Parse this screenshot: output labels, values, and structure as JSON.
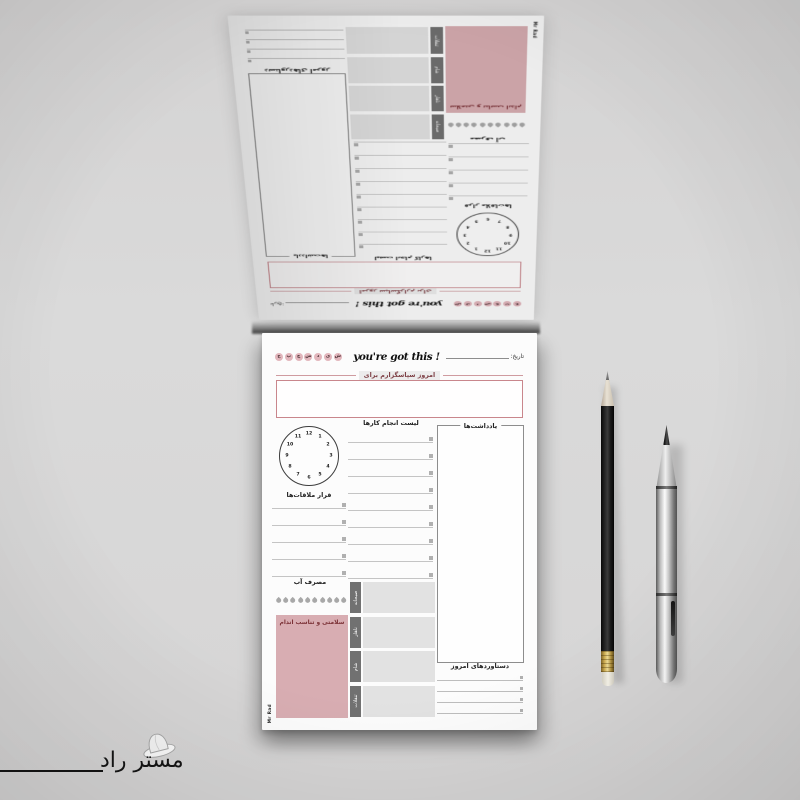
{
  "page": {
    "brand": "Mr Rad",
    "date_label": "تاریخ:",
    "motto": "you're got this !",
    "weekdays": [
      "ج",
      "پ",
      "چ",
      "س",
      "د",
      "ی",
      "ش"
    ],
    "gratitude_label": "امروز سپاسگزارم برای",
    "todo_heading": "لیست انجام کارها",
    "todo_rows": 9,
    "notes_heading": "یادداشت‌ها",
    "appointments_heading": "قرار ملاقات‌ها",
    "appointment_rows": 5,
    "water_heading": "مصرف آب",
    "water_drops": 10,
    "fitness_label": "سلامتی و تناسب اندام",
    "meals": [
      "صبحانه",
      "ناهار",
      "شام",
      "تنقلات"
    ],
    "achievements_heading": "دستاوردهای امروز",
    "achievement_rows": 4,
    "clock_numbers": [
      "12",
      "1",
      "2",
      "3",
      "4",
      "5",
      "6",
      "7",
      "8",
      "9",
      "10",
      "11"
    ]
  },
  "watermark": {
    "text": "مستر راد"
  },
  "colors": {
    "backdrop": "#d8d7d7",
    "paper": "#fcfcfc",
    "accent_pink_box": "#d8adb2",
    "weekday_circle_pink": "#e2b6bc",
    "gratitude_border_pink": "#c9868c",
    "meal_tab_gray": "#717171",
    "meal_box_gray": "#e2e2e2",
    "maroon_text": "#7b3136"
  }
}
